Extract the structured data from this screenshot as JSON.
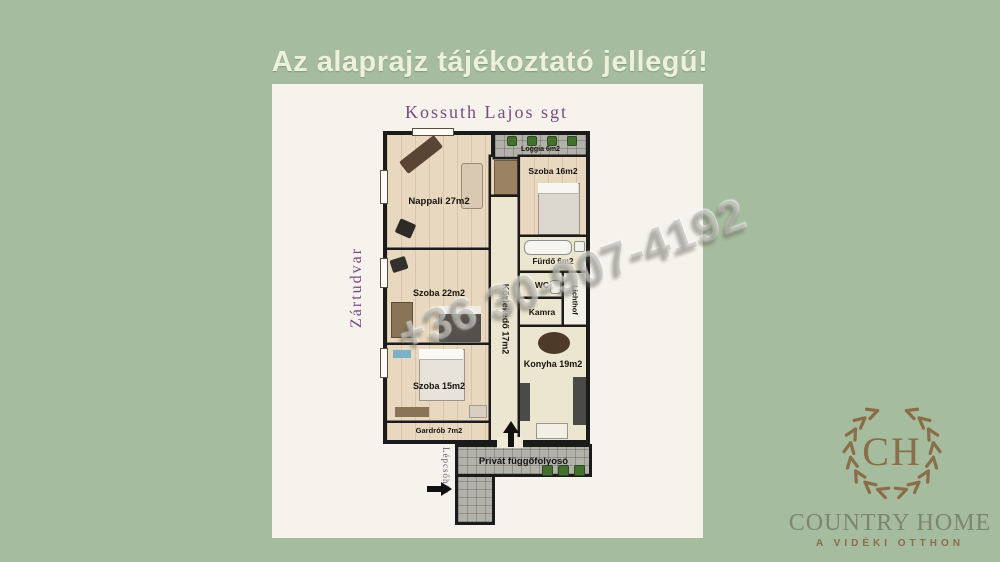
{
  "page": {
    "title": "Az alaprajz tájékoztató jellegű!"
  },
  "plan": {
    "street_label": "Kossuth Lajos sgt",
    "courtyard_label": "Zártudvar",
    "staircase_label": "Lépcsőház",
    "walkway_label": "Privát függőfolyosó",
    "rooms": {
      "nappali": "Nappali 27m2",
      "szoba16": "Szoba 16m2",
      "szoba22": "Szoba 22m2",
      "szoba15": "Szoba 15m2",
      "gardrob": "Gardrób 7m2",
      "kozlekedo": "Közlekedő 17m2",
      "furdo": "Fürdő 6m2",
      "wc": "WC",
      "kamra": "Kamra",
      "lichthof": "Lichthof",
      "konyha": "Konyha 19m2",
      "loggia": "Loggia 6m2"
    }
  },
  "watermark": {
    "phone": "+36 30-907-4192"
  },
  "logo": {
    "monogram": "CH",
    "name": "COUNTRY HOME",
    "tagline": "A VIDÉKI OTTHON"
  },
  "colors": {
    "background": "#a6bc9e",
    "accent_purple": "#7b4a80",
    "title_cream": "#edf0dd",
    "logo_brown": "#8a6d49",
    "logo_gray_green": "#7c8671",
    "wall_black": "#1b1b1b"
  }
}
